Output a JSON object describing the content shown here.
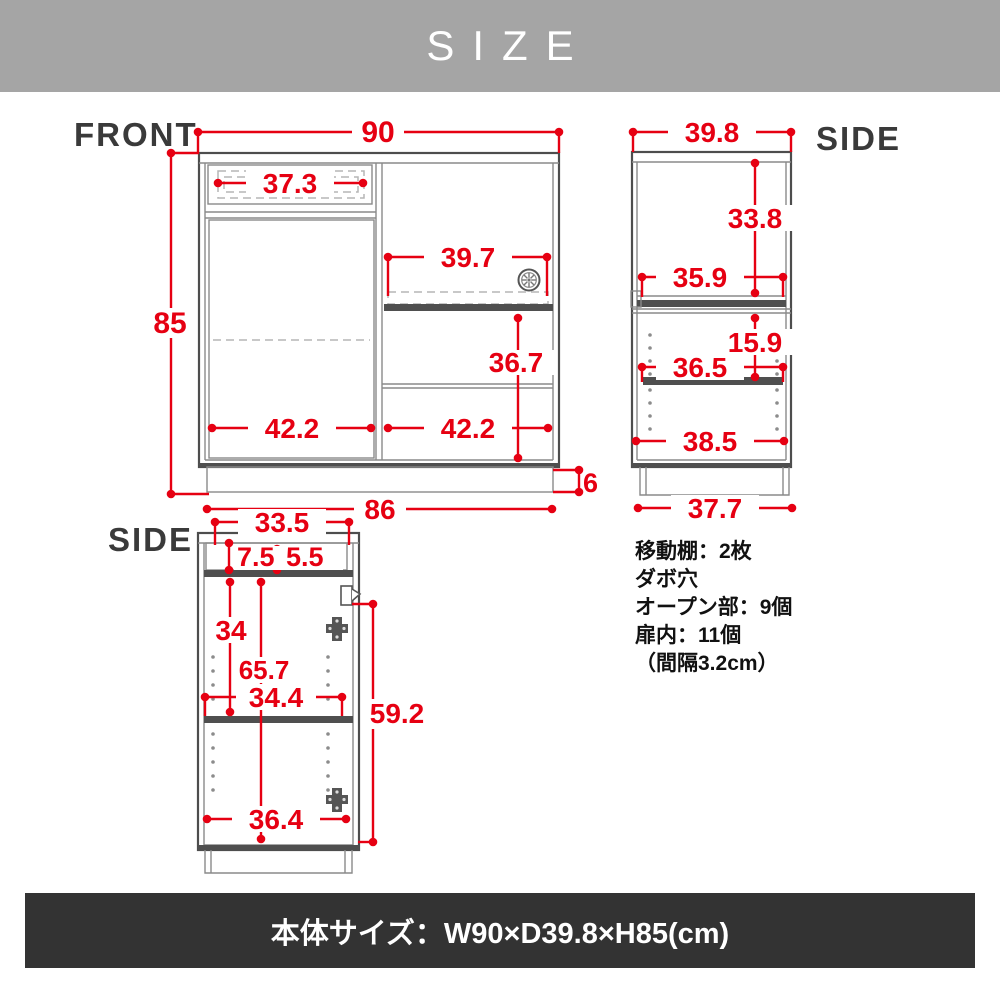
{
  "header": {
    "title": "SIZE"
  },
  "views": {
    "front": {
      "label": "FRONT",
      "dims": {
        "overall_width": "90",
        "overall_height": "85",
        "drawer_width": "37.3",
        "slide_shelf_width": "39.7",
        "open_section_height": "36.7",
        "left_inner_width": "42.2",
        "right_inner_width": "42.2",
        "base_width": "86",
        "base_height": "6"
      }
    },
    "side_top": {
      "label": "SIDE",
      "dims": {
        "overall_depth": "39.8",
        "upper_inner_height": "33.8",
        "upper_inner_depth": "35.9",
        "lower_top_gap": "15.9",
        "shelf_depth": "36.5",
        "lower_inner_depth": "38.5",
        "base_depth": "37.7"
      }
    },
    "side_bottom": {
      "label": "SIDE",
      "dims": {
        "top_inner_depth": "33.5",
        "drawer_front_height": "7.5",
        "drawer_inner_height": "5.5",
        "upper_door_inner": "34",
        "door_inner_height": "65.7",
        "shelf_inner_depth": "34.4",
        "door_height": "59.2",
        "bottom_inner_depth": "36.4"
      }
    }
  },
  "specs": {
    "lines": [
      "移動棚：2枚",
      "ダボ穴",
      "オープン部：9個",
      "扉内：11個",
      "（間隔3.2cm）"
    ]
  },
  "footer": {
    "size_label": "本体サイズ：W90×D39.8×H85(cm)"
  }
}
